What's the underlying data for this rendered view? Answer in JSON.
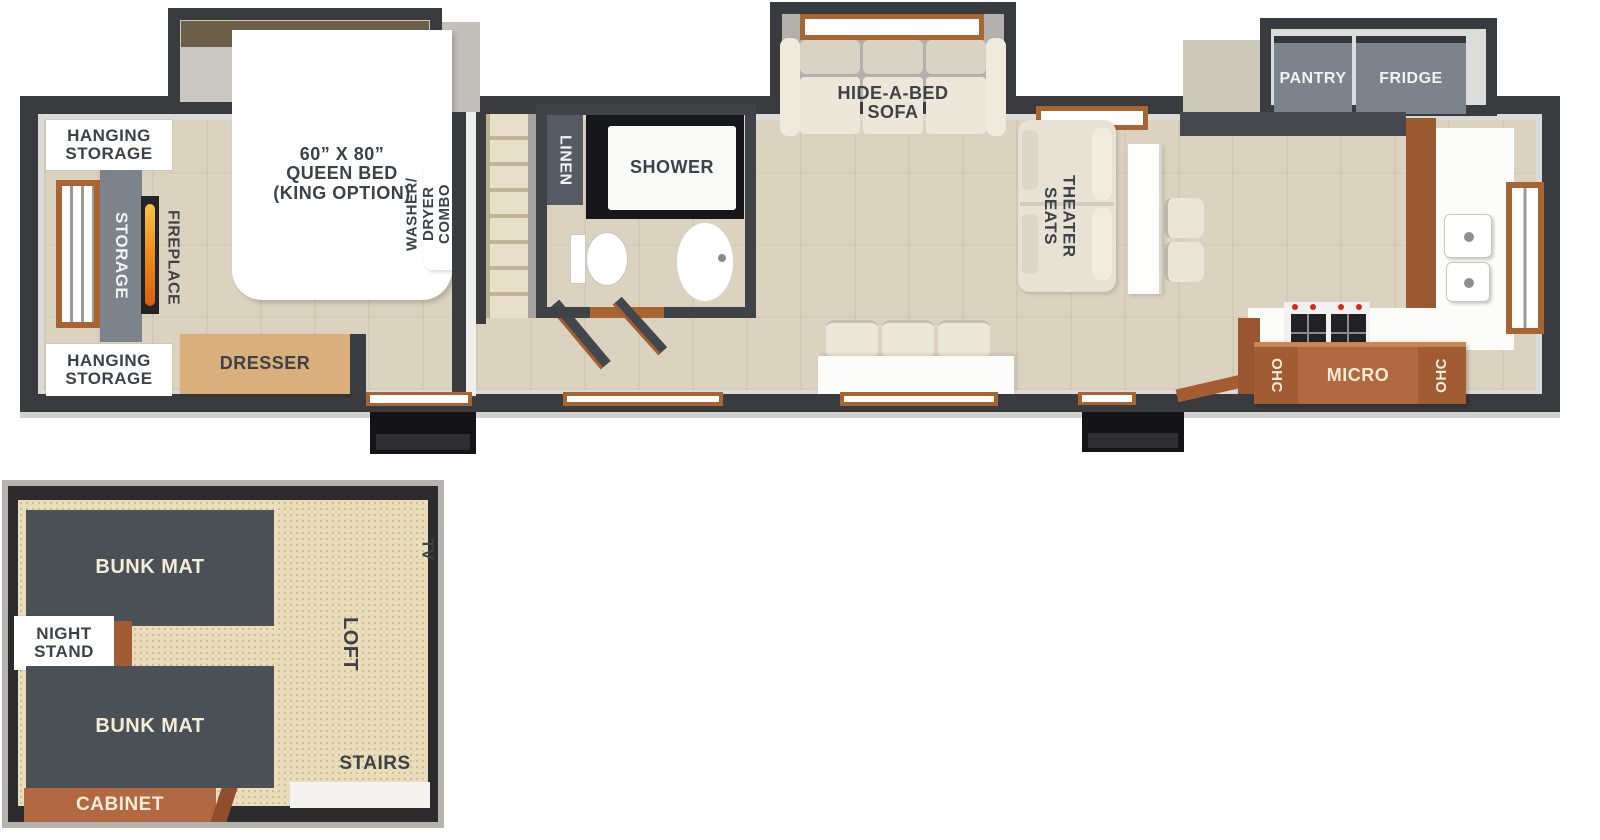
{
  "main": {
    "bedroom": {
      "hanging_storage_top": "HANGING\nSTORAGE",
      "storage": "STORAGE",
      "fireplace": "FIREPLACE",
      "bed": "60” X 80”\nQUEEN BED\n(KING OPTION)",
      "washer_dryer": "WASHER/\nDRYER\nCOMBO",
      "hanging_storage_bottom": "HANGING\nSTORAGE",
      "dresser": "DRESSER"
    },
    "bathroom": {
      "linen": "LINEN",
      "shower": "SHOWER"
    },
    "living": {
      "sofa": "HIDE-A-BED\nSOFA",
      "theater_seats": "THEATER\nSEATS"
    },
    "kitchen": {
      "pantry": "PANTRY",
      "fridge": "FRIDGE",
      "ohc_left": "OHC",
      "micro": "MICRO",
      "ohc_right": "OHC"
    }
  },
  "loft": {
    "bunk_mat_top": "BUNK MAT",
    "night_stand": "NIGHT\nSTAND",
    "bunk_mat_bottom": "BUNK MAT",
    "cabinet": "CABINET",
    "loft_label": "LOFT",
    "stairs_label": "STAIRS",
    "tv_label": "TV"
  },
  "colors": {
    "wall": "#3a3b3e",
    "wood_floor": "#dbd3c0",
    "slide_floor": "#b3b1ad",
    "cream_furniture": "#ece7d8",
    "dark_unit": "#565b63",
    "pantry_gray": "#7d838d",
    "storage_gray": "#7d838a",
    "cabinet_orange": "#b26840",
    "window_frame_orange": "#a96531",
    "label_dark": "#3e4248",
    "label_cream": "#f3ecd9",
    "loft_carpet": "#e9ddbb",
    "bunk_mat": "#4b5056",
    "entry_step_black": "#141416",
    "dresser_wood": "#d9b07b",
    "flame_orange": "#ef8f1f"
  }
}
